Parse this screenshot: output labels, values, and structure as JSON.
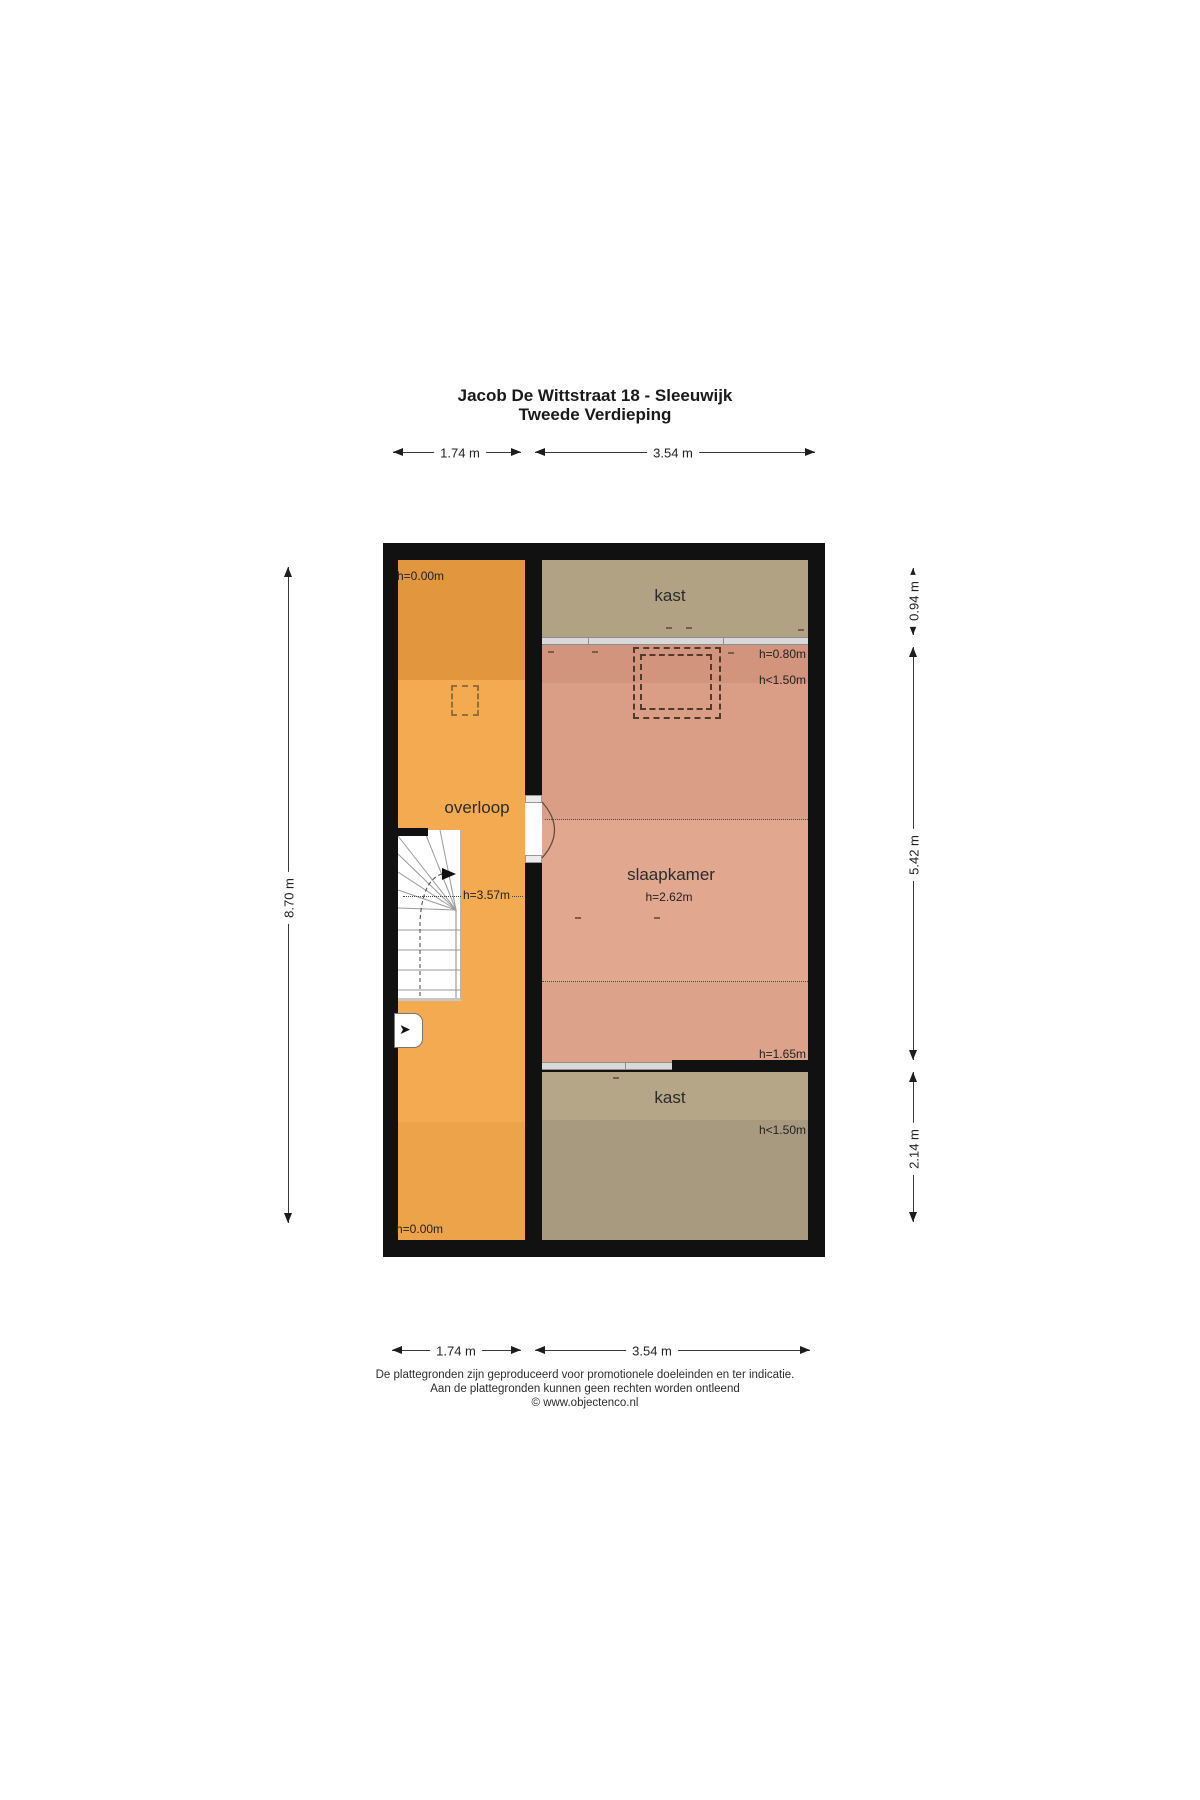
{
  "title": {
    "line1": "Jacob De Wittstraat 18 - Sleeuwijk",
    "line2": "Tweede Verdieping"
  },
  "dimensions": {
    "top": [
      "1.74 m",
      "3.54 m"
    ],
    "bottom": [
      "1.74 m",
      "3.54 m"
    ],
    "left": "8.70 m",
    "right": [
      "0.94 m",
      "5.42 m",
      "2.14 m"
    ]
  },
  "rooms": {
    "overloop": {
      "name": "overloop",
      "h_top": "h=0.00m",
      "h_ridge": "h=3.57m",
      "h_bottom": "h=0.00m"
    },
    "kast_top": {
      "name": "kast"
    },
    "slaapkamer": {
      "name": "slaapkamer",
      "h_ceiling": "h=2.62m",
      "h_back_wall": "h=0.80m",
      "h_low_zone": "h<1.50m",
      "h_front_wall": "h=1.65m"
    },
    "kast_bottom": {
      "name": "kast",
      "h_low_zone": "h<1.50m"
    }
  },
  "footer": {
    "line1": "De plattegronden zijn geproduceerd voor promotionele doeleinden en ter indicatie.",
    "line2": "Aan de plattegronden kunnen geen rechten worden ontleend",
    "line3": "© www.objectenco.nl"
  },
  "colors": {
    "wall": "#111111",
    "orange_dark": "#E2973E",
    "orange": "#F3AA50",
    "orange_low": "#ECA349",
    "salmon_dark": "#D2947C",
    "salmon_mid": "#DA9E86",
    "salmon": "#E1A88F",
    "salmon_mid2": "#DCA28A",
    "tan": "#B2A284",
    "tan_light": "#B5A687",
    "tan_dark": "#A89A7E",
    "divider_gray": "#D9D9D9"
  }
}
